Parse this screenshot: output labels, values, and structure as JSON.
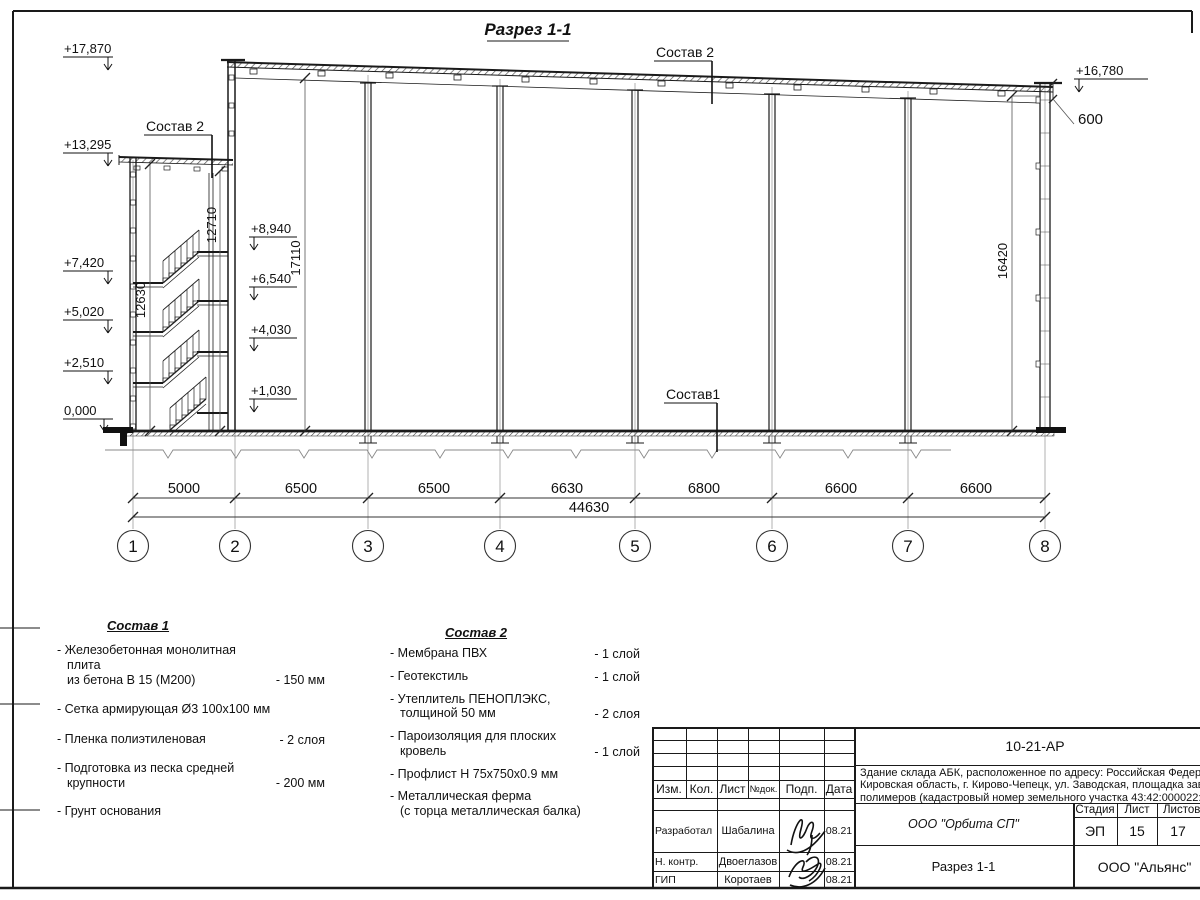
{
  "drawing": {
    "title": "Разрез 1-1",
    "callout_sostav2": "Состав 2",
    "callout_sostav1": "Состав1",
    "elev_left": [
      "+17,870",
      "+13,295",
      "+7,420",
      "+5,020",
      "+2,510",
      "0,000"
    ],
    "elev_inner": [
      "+8,940",
      "+6,540",
      "+4,030",
      "+1,030"
    ],
    "elev_right": "+16,780",
    "dim_600": "600",
    "vdim_stair": "12710",
    "vdim_tower_wall": "12630",
    "vdim_hall_left": "17110",
    "vdim_hall_right": "16420",
    "axes": [
      "1",
      "2",
      "3",
      "4",
      "5",
      "6",
      "7",
      "8"
    ],
    "spans": [
      "5000",
      "6500",
      "6500",
      "6630",
      "6800",
      "6600",
      "6600"
    ],
    "total": "44630"
  },
  "notes": {
    "sostav1": {
      "title": "Состав 1",
      "items": [
        {
          "name": "- Железобетонная  монолитная плита\nиз бетона В 15 (М200)",
          "value": "- 150 мм"
        },
        {
          "name": "- Сетка армирующая Ø3 100х100 мм",
          "value": ""
        },
        {
          "name": "- Пленка полиэтиленовая",
          "value": "-  2 слоя"
        },
        {
          "name": "- Подготовка из песка средней\nкрупности",
          "value": "- 200 мм"
        },
        {
          "name": "- Грунт основания",
          "value": ""
        }
      ]
    },
    "sostav2": {
      "title": "Состав 2",
      "items": [
        {
          "name": "- Мембрана ПВХ",
          "value": "- 1 слой"
        },
        {
          "name": "- Геотекстиль",
          "value": "- 1 слой"
        },
        {
          "name": "- Утеплитель ПЕНОПЛЭКС,\nтолщиной 50 мм",
          "value": "- 2 слоя"
        },
        {
          "name": "- Пароизоляция для плоских кровель",
          "value": "- 1 слой"
        },
        {
          "name": "- Профлист Н 75х750х0.9 мм",
          "value": ""
        },
        {
          "name": "- Металлическая ферма\n(с торца металлическая балка)",
          "value": ""
        }
      ]
    }
  },
  "titleblock": {
    "code": "10-21-АР",
    "description": [
      "Здание склада АБК, расположенное по адресу: Российская Федерац",
      "Кировская область, г. Кирово-Чепецк, ул. Заводская, площадка заво",
      "полимеров (кадастровый номер земельного участка 43:42:000022:3"
    ],
    "cols": {
      "izm": "Изм.",
      "kol": "Кол.",
      "list": "Лист",
      "ndok": "№док.",
      "podp": "Подп.",
      "data": "Дата"
    },
    "rows": [
      {
        "role": "Разработал",
        "name": "Шабалина",
        "date": "08.21"
      },
      {
        "role": "Н. контр.",
        "name": "Двоеглазов",
        "date": "08.21"
      },
      {
        "role": "ГИП",
        "name": "Коротаев",
        "date": "08.21"
      }
    ],
    "org": "ООО \"Орбита СП\"",
    "stage_label": "Стадия",
    "sheet_label": "Лист",
    "sheets_label": "Листов",
    "stage": "ЭП",
    "sheet": "15",
    "sheets": "17",
    "doc_title": "Разрез 1-1",
    "firm": "ООО \"Альянс\""
  }
}
